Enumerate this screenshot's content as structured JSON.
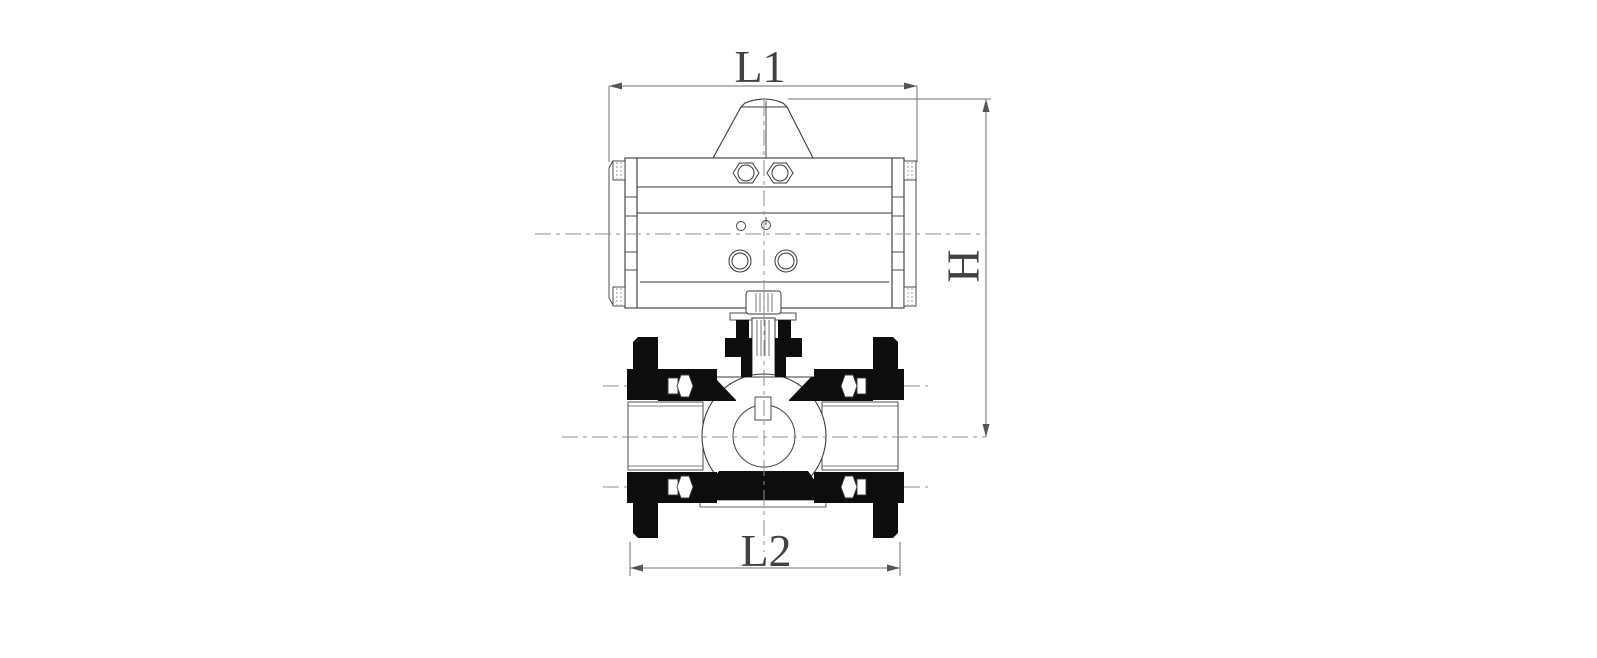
{
  "drawing": {
    "kind": "technical-dimension-drawing",
    "subject": "pneumatic-actuator-on-flanged-ball-valve",
    "view": "front-cross-section",
    "dimensions": {
      "l1": {
        "label": "L1",
        "measures": "actuator-overall-length",
        "position": "top"
      },
      "h": {
        "label": "H",
        "measures": "height-actuator-top-to-valve-centerline",
        "position": "right",
        "rotated": true
      },
      "l2": {
        "label": "L2",
        "measures": "valve-face-to-face-length",
        "position": "bottom"
      }
    },
    "colors": {
      "background": "#ffffff",
      "outline": "#3a3a3a",
      "section_fill": "#0d0d0d",
      "centerline": "#8f8f8f",
      "dimension_line": "#707070",
      "label_text": "#414141",
      "seat_gray": "#c4c4c4"
    }
  }
}
